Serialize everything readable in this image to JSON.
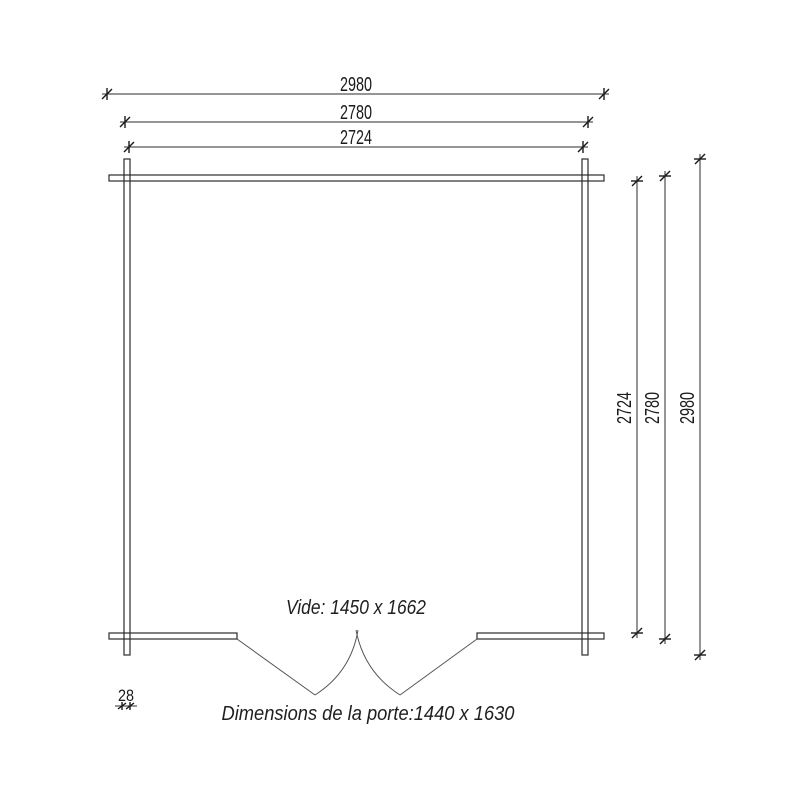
{
  "drawing": {
    "type": "floor-plan",
    "background_color": "#ffffff",
    "line_color": "#2b2b2b",
    "door_line_color": "#555555",
    "dimensions_top": [
      {
        "name": "overall-width",
        "label": "2980"
      },
      {
        "name": "outer-wall-width",
        "label": "2780"
      },
      {
        "name": "inner-width",
        "label": "2724"
      }
    ],
    "dimensions_right": [
      {
        "name": "inner-depth",
        "label": "2724"
      },
      {
        "name": "outer-wall-depth",
        "label": "2780"
      },
      {
        "name": "overall-depth",
        "label": "2980"
      }
    ],
    "wall_thickness": {
      "label": "28"
    },
    "annotations": {
      "clear_opening": "Vide: 1450 x 1662",
      "door_size": "Dimensions de la porte:1440 x 1630"
    }
  }
}
